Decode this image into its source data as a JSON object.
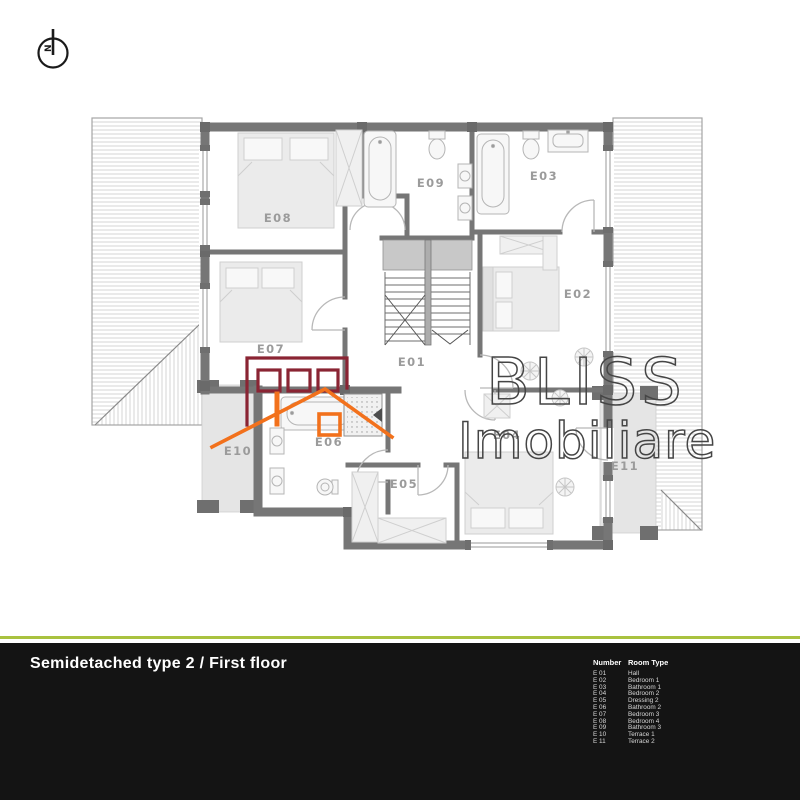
{
  "compass": {
    "label": "N"
  },
  "watermark": {
    "line1": "BLISS",
    "line2": "Imobiliare"
  },
  "plan": {
    "labels": [
      {
        "text": "E08"
      },
      {
        "text": "E09"
      },
      {
        "text": "E03"
      },
      {
        "text": "E02"
      },
      {
        "text": "E07"
      },
      {
        "text": "E01"
      },
      {
        "text": "E10"
      },
      {
        "text": "E06"
      },
      {
        "text": "E05"
      },
      {
        "text": "E04"
      },
      {
        "text": "E11"
      }
    ]
  },
  "legend": {
    "header": {
      "col1": "Number",
      "col2": "Room Type"
    },
    "rows": [
      {
        "number": "E 01",
        "type": "Hall"
      },
      {
        "number": "E 02",
        "type": "Bedroom 1"
      },
      {
        "number": "E 03",
        "type": "Bathroom 1"
      },
      {
        "number": "E 04",
        "type": "Bedroom 2"
      },
      {
        "number": "E 05",
        "type": "Dressing 2"
      },
      {
        "number": "E 06",
        "type": "Bathroom 2"
      },
      {
        "number": "E 07",
        "type": "Bedroom 3"
      },
      {
        "number": "E 08",
        "type": "Bedroom 4"
      },
      {
        "number": "E 09",
        "type": "Bathroom 3"
      },
      {
        "number": "E 10",
        "type": "Terrace 1"
      },
      {
        "number": "E 11",
        "type": "Terrace 2"
      }
    ]
  },
  "footer": {
    "title": "Semidetached type 2 / First floor"
  },
  "colors": {
    "logo_red": "#8a2433",
    "logo_orange": "#f2711c",
    "watermark": "#454545",
    "accent_green": "#a9c23f",
    "bar_background": "#141414",
    "wall_gray": "#767676",
    "terrace_fill": "#e5e5e5"
  }
}
